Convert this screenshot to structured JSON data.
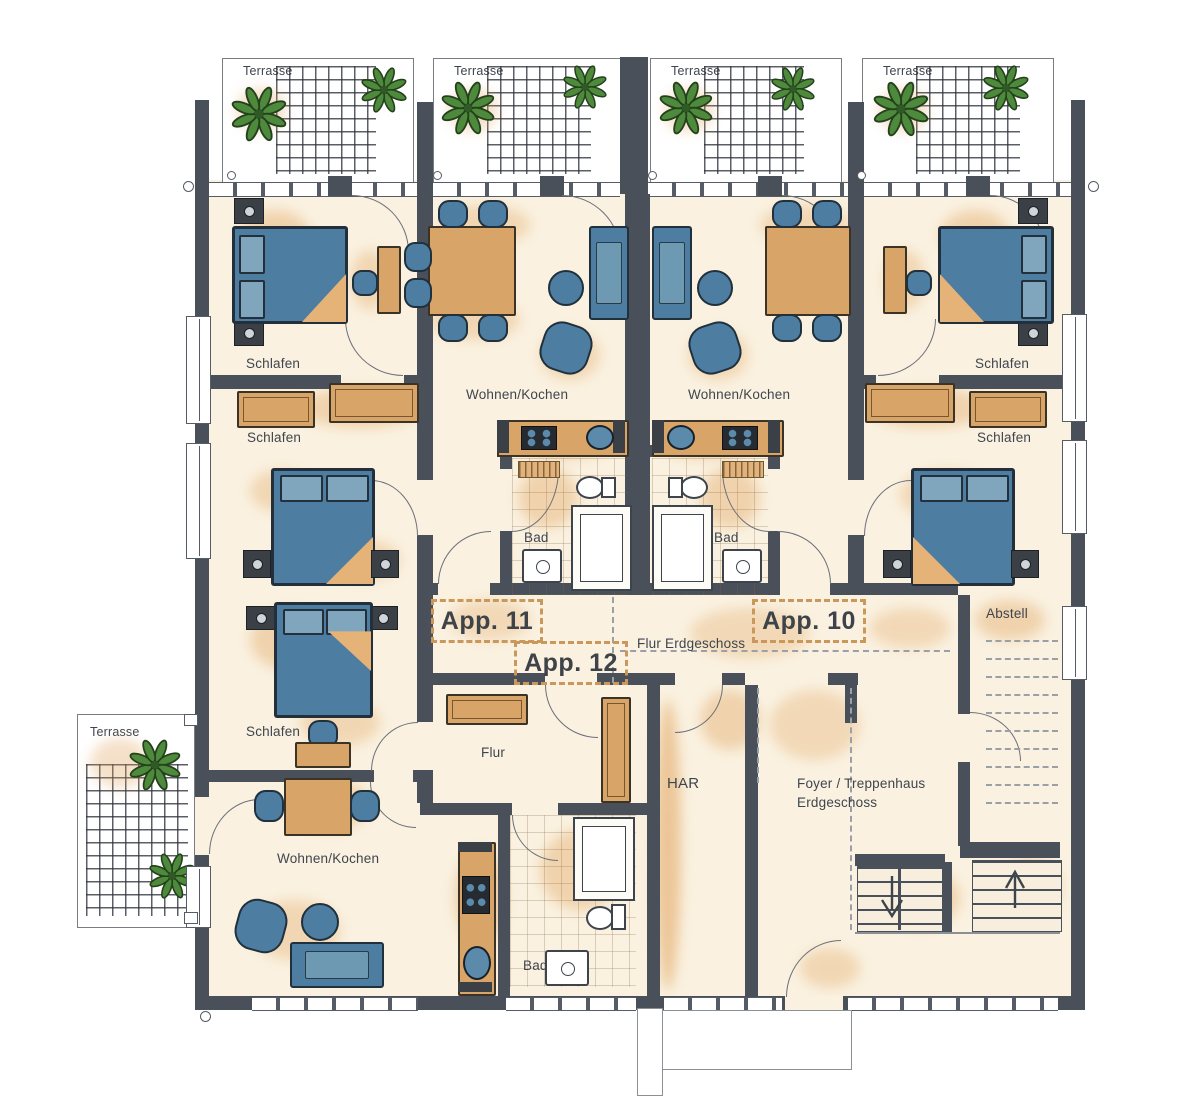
{
  "colors": {
    "wall": "#4a505a",
    "floor": "#faf1e0",
    "furniture": "#4d7da1",
    "wood": "#d9a468",
    "accent": "#de9b4f",
    "plant": "#4e8a3c",
    "app_dash": "#c9985a",
    "text": "#3f454e"
  },
  "rooms": {
    "terrace": "Terrasse",
    "bedroom": "Schlafen",
    "living_kitchen": "Wohnen/Kochen",
    "bath": "Bad",
    "hall": "Flur",
    "hall_ground": "Flur Erdgeschoss",
    "storage": "Abstell",
    "utility": "HAR",
    "foyer_line1": "Foyer / Treppenhaus",
    "foyer_line2": "Erdgeschoss"
  },
  "apartments": {
    "app10": "App. 10",
    "app11": "App. 11",
    "app12": "App. 12"
  }
}
